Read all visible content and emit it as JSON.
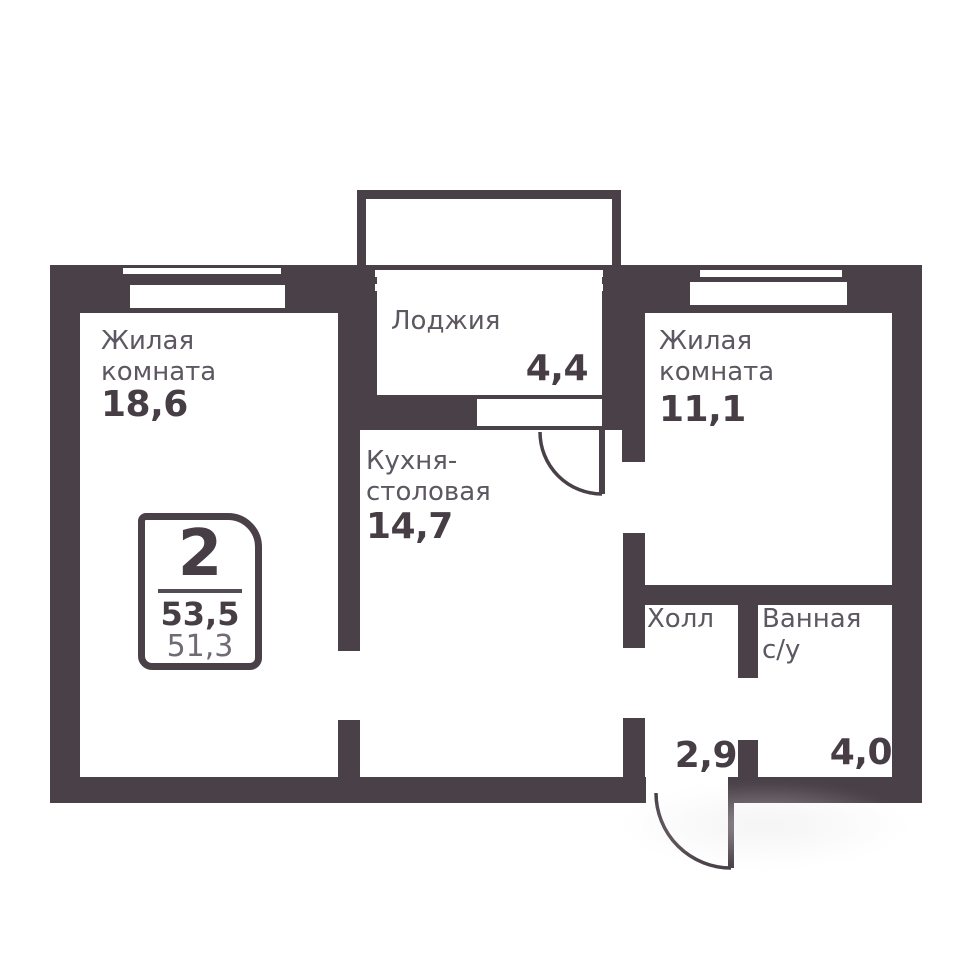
{
  "badge": {
    "room_count": "2",
    "total_area": "53,5",
    "living_area": "51,3"
  },
  "rooms": {
    "living1": {
      "line1": "Жилая",
      "line2": "комната",
      "area": "18,6"
    },
    "loggia": {
      "line1": "Лоджия",
      "area": "4,4"
    },
    "living2": {
      "line1": "Жилая",
      "line2": "комната",
      "area": "11,1"
    },
    "kitchen": {
      "line1": "Кухня-",
      "line2": "столовая",
      "area": "14,7"
    },
    "hall": {
      "line1": "Холл",
      "area": "2,9"
    },
    "bathroom": {
      "line1": "Ванная",
      "line2": "с/у",
      "area": "4,0"
    }
  },
  "colors": {
    "wall": "#4a4048",
    "label": "#5c5761",
    "number": "#463d45",
    "secondary": "#6f6a73",
    "divider": "#514c55"
  }
}
